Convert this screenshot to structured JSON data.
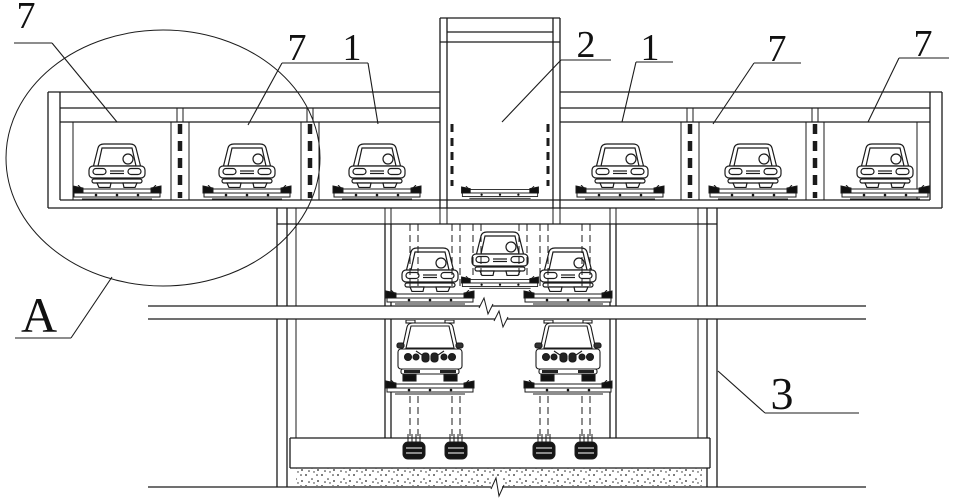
{
  "figure": {
    "kind": "sectional line drawing of a multi-level mechanical parking system with underground pit",
    "colors": {
      "background": "#ffffff",
      "line": "#1b1b1b"
    },
    "callouts": {
      "c7a": "7",
      "c7b": "7",
      "c1a": "1",
      "c2": "2",
      "c1b": "1",
      "c7c": "7",
      "c7d": "7",
      "c3": "3",
      "cA": "A"
    },
    "counts": {
      "parking_bays_above_ground": 7,
      "cars_above_ground": 6,
      "cars_in_pit_upper_row": 3,
      "cars_in_pit_lower_row": 2,
      "foundation_anchors": 4
    }
  }
}
